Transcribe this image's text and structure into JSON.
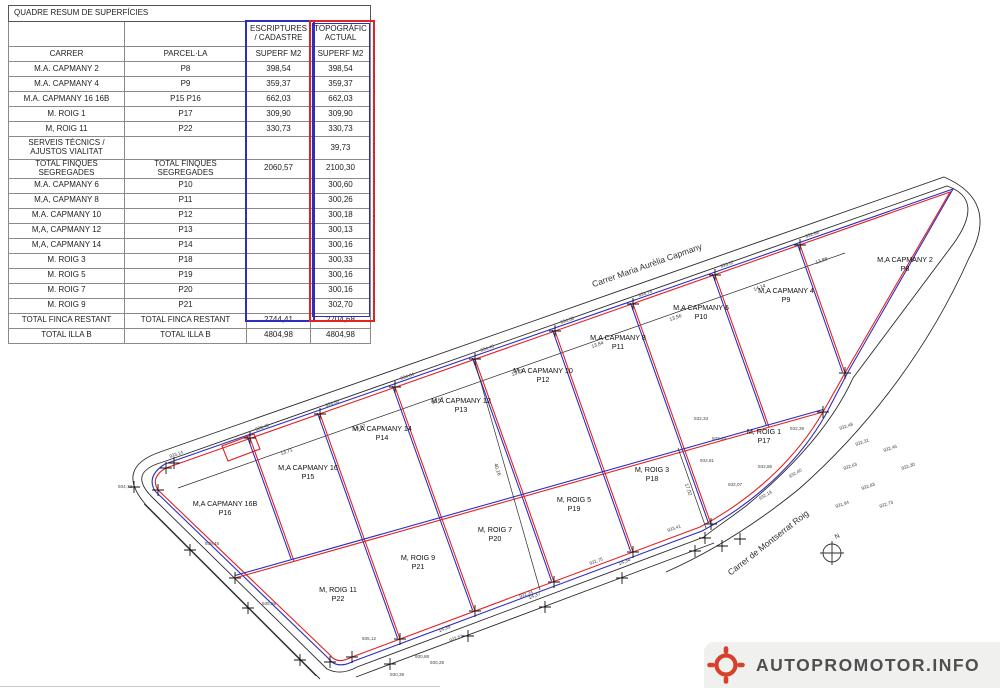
{
  "colors": {
    "escriptures_blue": "#2d2dc0",
    "topografic_red": "#e32222",
    "logo_red": "#d9402c",
    "logo_text_gray": "#4f4f4f"
  },
  "table": {
    "title": "QUADRE RESUM DE SUPERFÍCIES",
    "group_headers": [
      "ESCRIPTURES / CADASTRE",
      "TOPOGRÀFIC ACTUAL"
    ],
    "sub_headers": [
      "CARRER",
      "PARCEL·LA",
      "SUPERF M2",
      "SUPERF M2"
    ],
    "rows": [
      {
        "carrer": "M.A. CAPMANY 2",
        "parcella": "P8",
        "escriptures": "398,54",
        "topografic": "398,54",
        "tall": false
      },
      {
        "carrer": "M.A. CAPMANY 4",
        "parcella": "P9",
        "escriptures": "359,37",
        "topografic": "359,37",
        "tall": false
      },
      {
        "carrer": "M.A. CAPMANY 16 16B",
        "parcella": "P15 P16",
        "escriptures": "662,03",
        "topografic": "662,03",
        "tall": false
      },
      {
        "carrer": "M. ROIG 1",
        "parcella": "P17",
        "escriptures": "309,90",
        "topografic": "309,90",
        "tall": false
      },
      {
        "carrer": "M, ROIG 11",
        "parcella": "P22",
        "escriptures": "330,73",
        "topografic": "330,73",
        "tall": false
      },
      {
        "carrer": "SERVEIS TÈCNICS / AJUSTOS VIALITAT",
        "parcella": "",
        "escriptures": "",
        "topografic": "39,73",
        "tall": true
      },
      {
        "carrer": "TOTAL FINQUES SEGREGADES",
        "parcella": "TOTAL FINQUES SEGREGADES",
        "escriptures": "2060,57",
        "topografic": "2100,30",
        "tall": false
      },
      {
        "carrer": "M.A. CAPMANY 6",
        "parcella": "P10",
        "escriptures": "",
        "topografic": "300,60",
        "tall": false
      },
      {
        "carrer": "M,A, CAPMANY 8",
        "parcella": "P11",
        "escriptures": "",
        "topografic": "300,26",
        "tall": false
      },
      {
        "carrer": "M.A. CAPMANY 10",
        "parcella": "P12",
        "escriptures": "",
        "topografic": "300,18",
        "tall": false
      },
      {
        "carrer": "M,A, CAPMANY 12",
        "parcella": "P13",
        "escriptures": "",
        "topografic": "300,13",
        "tall": false
      },
      {
        "carrer": "M,A, CAPMANY 14",
        "parcella": "P14",
        "escriptures": "",
        "topografic": "300,16",
        "tall": false
      },
      {
        "carrer": "M. ROIG 3",
        "parcella": "P18",
        "escriptures": "",
        "topografic": "300,33",
        "tall": false
      },
      {
        "carrer": "M. ROIG 5",
        "parcella": "P19",
        "escriptures": "",
        "topografic": "300,16",
        "tall": false
      },
      {
        "carrer": "M. ROIG 7",
        "parcella": "P20",
        "escriptures": "",
        "topografic": "300,16",
        "tall": false
      },
      {
        "carrer": "M. ROIG 9",
        "parcella": "P21",
        "escriptures": "",
        "topografic": "302,70",
        "tall": false
      },
      {
        "carrer": "TOTAL FINCA RESTANT",
        "parcella": "TOTAL FINCA RESTANT",
        "escriptures": "2744,41",
        "topografic": "2704,68",
        "tall": false
      },
      {
        "carrer": "TOTAL ILLA B",
        "parcella": "TOTAL ILLA B",
        "escriptures": "4804,98",
        "topografic": "4804,98",
        "tall": false
      }
    ]
  },
  "map": {
    "parcels": [
      {
        "name": "M,A CAPMANY 2",
        "code": "P8",
        "x": 905,
        "y": 262
      },
      {
        "name": "M,A CAPMANY 4",
        "code": "P9",
        "x": 786,
        "y": 293
      },
      {
        "name": "M,A CAPMANY 6",
        "code": "P10",
        "x": 701,
        "y": 310
      },
      {
        "name": "M,A CAPMANY 8",
        "code": "P11",
        "x": 618,
        "y": 340
      },
      {
        "name": "M,A CAPMANY 10",
        "code": "P12",
        "x": 543,
        "y": 373
      },
      {
        "name": "M,A CAPMANY 12",
        "code": "P13",
        "x": 461,
        "y": 403
      },
      {
        "name": "M,A CAPMANY 14",
        "code": "P14",
        "x": 382,
        "y": 431
      },
      {
        "name": "M,A CAPMANY 16",
        "code": "P15",
        "x": 308,
        "y": 470
      },
      {
        "name": "M,A CAPMANY 16B",
        "code": "P16",
        "x": 225,
        "y": 506
      },
      {
        "name": "M, ROIG 1",
        "code": "P17",
        "x": 764,
        "y": 434
      },
      {
        "name": "M, ROIG 3",
        "code": "P18",
        "x": 652,
        "y": 472
      },
      {
        "name": "M, ROIG 5",
        "code": "P19",
        "x": 574,
        "y": 502
      },
      {
        "name": "M, ROIG 7",
        "code": "P20",
        "x": 495,
        "y": 532
      },
      {
        "name": "M, ROIG 9",
        "code": "P21",
        "x": 418,
        "y": 560
      },
      {
        "name": "M, ROIG 11",
        "code": "P22",
        "x": 338,
        "y": 592
      }
    ],
    "streets": [
      {
        "text": "Carrer Maria Aurèlia Capmany",
        "x": 648,
        "y": 268,
        "rot": -19.4
      },
      {
        "text": "Carrer de Montserrat Roig",
        "x": 770,
        "y": 545,
        "rot": -38
      }
    ],
    "north_label": "N",
    "divisions_top": [
      [
        250,
        438,
        294,
        561
      ],
      [
        320,
        414,
        365,
        541
      ],
      [
        395,
        387,
        442,
        519
      ],
      [
        475,
        359,
        524,
        496
      ],
      [
        555,
        331,
        605,
        473
      ],
      [
        633,
        304,
        685,
        451
      ],
      [
        715,
        275,
        769,
        427
      ],
      [
        800,
        245,
        845,
        373
      ]
    ],
    "divisions_bottom": [
      [
        365,
        541,
        400,
        639
      ],
      [
        442,
        519,
        475,
        611
      ],
      [
        524,
        496,
        554,
        582
      ],
      [
        605,
        473,
        633,
        552
      ],
      [
        685,
        451,
        711,
        524
      ]
    ],
    "interrow_line": [
      235,
      578,
      823,
      412
    ],
    "survey_crosses": [
      [
        250,
        438
      ],
      [
        320,
        414
      ],
      [
        395,
        387
      ],
      [
        475,
        359
      ],
      [
        555,
        331
      ],
      [
        633,
        304
      ],
      [
        715,
        275
      ],
      [
        800,
        245
      ],
      [
        166,
        468
      ],
      [
        174,
        463
      ],
      [
        158,
        490
      ],
      [
        235,
        578
      ],
      [
        330,
        662
      ],
      [
        352,
        657
      ],
      [
        400,
        639
      ],
      [
        475,
        611
      ],
      [
        554,
        582
      ],
      [
        633,
        552
      ],
      [
        711,
        524
      ],
      [
        390,
        664
      ],
      [
        468,
        636
      ],
      [
        545,
        607
      ],
      [
        622,
        578
      ],
      [
        695,
        551
      ],
      [
        190,
        550
      ],
      [
        248,
        608
      ],
      [
        300,
        660
      ],
      [
        134,
        487
      ],
      [
        845,
        373
      ],
      [
        823,
        412
      ],
      [
        705,
        538
      ],
      [
        722,
        546
      ],
      [
        740,
        539
      ]
    ],
    "dim_labels": [
      {
        "x": 287,
        "y": 453,
        "t": "13,71",
        "r": -19.4
      },
      {
        "x": 360,
        "y": 429,
        "t": "13,67",
        "r": -19.4
      },
      {
        "x": 438,
        "y": 402,
        "t": "13,67",
        "r": -19.4
      },
      {
        "x": 518,
        "y": 374,
        "t": "13,79",
        "r": -19.4
      },
      {
        "x": 598,
        "y": 346,
        "t": "13,84",
        "r": -19.4
      },
      {
        "x": 676,
        "y": 319,
        "t": "13,56",
        "r": -19.4
      },
      {
        "x": 760,
        "y": 289,
        "t": "14,14",
        "r": -19.4
      },
      {
        "x": 822,
        "y": 262,
        "t": "13,88",
        "r": -19.4
      },
      {
        "x": 445,
        "y": 630,
        "t": "14,39",
        "r": -20.5
      },
      {
        "x": 535,
        "y": 597,
        "t": "14,37",
        "r": -20.5
      },
      {
        "x": 625,
        "y": 563,
        "t": "14,34",
        "r": -20.5
      },
      {
        "x": 496,
        "y": 470,
        "t": "40,16",
        "r": 72
      },
      {
        "x": 687,
        "y": 490,
        "t": "17,02",
        "r": 70
      }
    ],
    "elevation_labels": [
      {
        "x": 256,
        "y": 431,
        "t": "933,48",
        "r": -19
      },
      {
        "x": 326,
        "y": 407,
        "t": "933,50",
        "r": -19
      },
      {
        "x": 401,
        "y": 380,
        "t": "934,04",
        "r": -19
      },
      {
        "x": 481,
        "y": 352,
        "t": "934,45",
        "r": -19
      },
      {
        "x": 561,
        "y": 324,
        "t": "934,58",
        "r": -19
      },
      {
        "x": 639,
        "y": 297,
        "t": "933,79",
        "r": -19
      },
      {
        "x": 721,
        "y": 268,
        "t": "933,57",
        "r": -19
      },
      {
        "x": 806,
        "y": 238,
        "t": "932,88",
        "r": -19
      },
      {
        "x": 840,
        "y": 430,
        "t": "932,48",
        "r": -19
      },
      {
        "x": 856,
        "y": 446,
        "t": "932,31",
        "r": -19
      },
      {
        "x": 884,
        "y": 452,
        "t": "932,46",
        "r": -19
      },
      {
        "x": 902,
        "y": 470,
        "t": "932,30",
        "r": -19
      },
      {
        "x": 844,
        "y": 470,
        "t": "932,63",
        "r": -19
      },
      {
        "x": 862,
        "y": 490,
        "t": "932,83",
        "r": -19
      },
      {
        "x": 880,
        "y": 508,
        "t": "932,73",
        "r": -19
      },
      {
        "x": 836,
        "y": 508,
        "t": "931,94",
        "r": -19
      },
      {
        "x": 712,
        "y": 440,
        "t": "932,49",
        "r": 0
      },
      {
        "x": 700,
        "y": 462,
        "t": "932,81",
        "r": 0
      },
      {
        "x": 758,
        "y": 468,
        "t": "932,86",
        "r": 0
      },
      {
        "x": 728,
        "y": 486,
        "t": "932,07",
        "r": 0
      },
      {
        "x": 694,
        "y": 420,
        "t": "932,33",
        "r": 0
      },
      {
        "x": 790,
        "y": 430,
        "t": "932,39",
        "r": 0
      },
      {
        "x": 590,
        "y": 565,
        "t": "932,75",
        "r": -20
      },
      {
        "x": 520,
        "y": 598,
        "t": "931,24",
        "r": -20
      },
      {
        "x": 450,
        "y": 642,
        "t": "932,52",
        "r": -20
      },
      {
        "x": 415,
        "y": 658,
        "t": "930,88",
        "r": 0
      },
      {
        "x": 668,
        "y": 532,
        "t": "933,41",
        "r": -20
      },
      {
        "x": 760,
        "y": 500,
        "t": "932,19",
        "r": -30
      },
      {
        "x": 790,
        "y": 478,
        "t": "932,40",
        "r": -30
      },
      {
        "x": 205,
        "y": 545,
        "t": "935,45",
        "r": 0
      },
      {
        "x": 262,
        "y": 605,
        "t": "935,89",
        "r": 0
      },
      {
        "x": 118,
        "y": 488,
        "t": "934,72",
        "r": 0
      },
      {
        "x": 170,
        "y": 458,
        "t": "933,14",
        "r": -19
      },
      {
        "x": 362,
        "y": 640,
        "t": "935,12",
        "r": 0
      },
      {
        "x": 390,
        "y": 676,
        "t": "930,39",
        "r": 0
      },
      {
        "x": 430,
        "y": 664,
        "t": "930,28",
        "r": 0
      }
    ]
  },
  "logo": {
    "text": "AUTOPROMOTOR.INFO"
  }
}
